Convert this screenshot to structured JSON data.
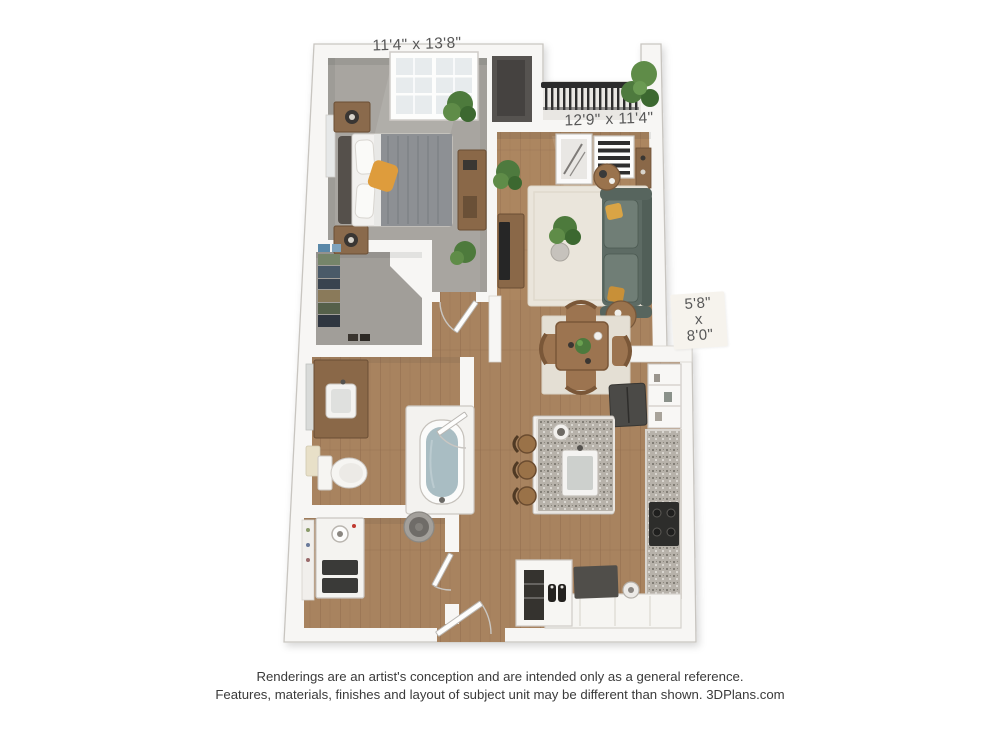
{
  "floor_plan": {
    "rooms": {
      "bedroom": {
        "dimensions": "11'4\" x 13'8\""
      },
      "living_room": {
        "dimensions": "12'9\" x 11'4\""
      },
      "balcony": {
        "dim_width": "5'8\"",
        "dim_separator": "x",
        "dim_height": "8'0\""
      }
    },
    "disclaimer": {
      "line1": "Renderings are an artist's conception and are intended only as a general reference.",
      "line2": "Features, materials, finishes and layout of subject unit may be different than shown. 3DPlans.com"
    },
    "colors": {
      "wall": "#f7f6f4",
      "wall_edge": "#c8c5c0",
      "wood_floor": "#a8835f",
      "carpet": "#a8a5a0",
      "sofa": "#5d6b64",
      "accent_pillow": "#d9a445",
      "rug": "#eae5db",
      "countertop_granite": "#b7b2aa",
      "balcony_railing": "#2c2c2c",
      "plant_green": "#4e7a3e",
      "bed_duvet": "#8d9094",
      "dimension_text": "#575757",
      "disclaimer_text": "#3a3a3a"
    }
  }
}
